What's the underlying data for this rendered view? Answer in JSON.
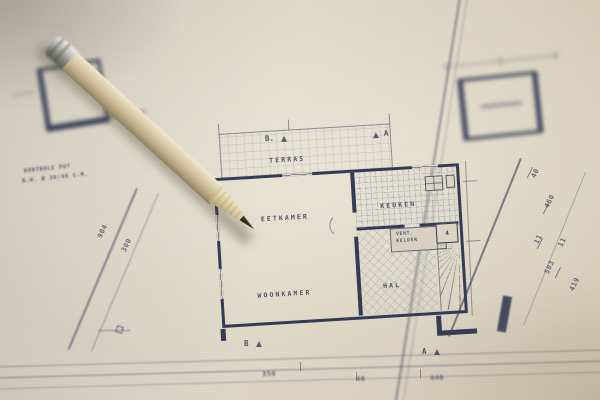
{
  "plan": {
    "rooms": {
      "terras": "TERRAS",
      "eetkamer": "EETKAMER",
      "woonkamer": "WOONKAMER",
      "keuken": "KEUKEN",
      "hal": "HAL",
      "vent_kelder_line1": "VENT.",
      "vent_kelder_line2": "KELDER"
    },
    "fixture_numbers": {
      "stair_box": "4"
    },
    "markers": {
      "top_left": "B.",
      "top_right": "A",
      "bottom_left": "B",
      "bottom_right": "A"
    },
    "annotation": {
      "line1": "KONTROLE PUT",
      "line2": "N.W. Ø 30/40 C.M."
    },
    "dimensions": {
      "left": [
        "904",
        "300"
      ],
      "right": [
        "40",
        "460",
        "11",
        "11",
        "503",
        "419"
      ],
      "bottom": [
        "350",
        "40",
        "440"
      ]
    }
  },
  "colors": {
    "paper": "#d6cfc0",
    "ink": "#333b54",
    "hatch": "#8e99b5",
    "pencil_wood": "#cfc0a0",
    "pencil_ferrule": "#c6c6c2",
    "graphite": "#2d2b28"
  }
}
